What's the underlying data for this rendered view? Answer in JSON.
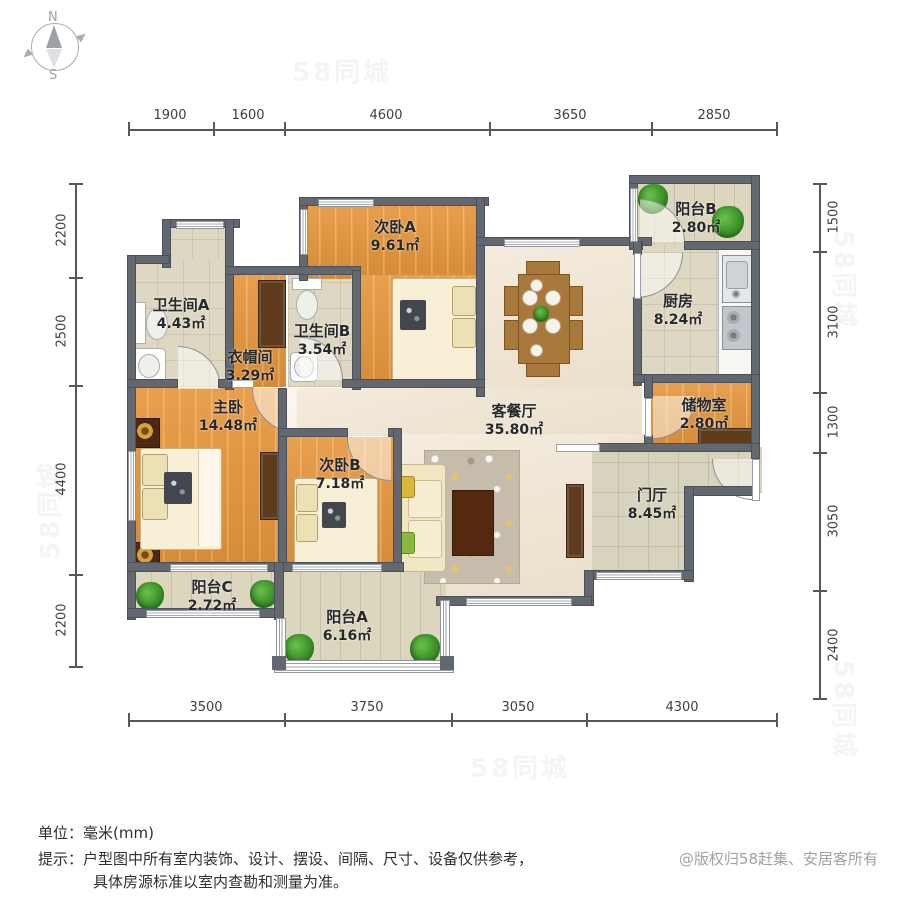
{
  "compass": {
    "north": "N",
    "south": "S"
  },
  "watermark": "58同城",
  "dimensions": {
    "top": [
      "1900",
      "1600",
      "4600",
      "3650",
      "2850"
    ],
    "bottom": [
      "3500",
      "3750",
      "3050",
      "4300"
    ],
    "left": [
      "2200",
      "2500",
      "4400",
      "2200"
    ],
    "right": [
      "1500",
      "3100",
      "1300",
      "3050",
      "2400"
    ]
  },
  "rooms": [
    {
      "id": "bedroom-a",
      "name": "次卧A",
      "area": "9.61㎡"
    },
    {
      "id": "balcony-b",
      "name": "阳台B",
      "area": "2.80㎡"
    },
    {
      "id": "kitchen",
      "name": "厨房",
      "area": "8.24㎡"
    },
    {
      "id": "storage",
      "name": "储物室",
      "area": "2.80㎡"
    },
    {
      "id": "bathroom-a",
      "name": "卫生间A",
      "area": "4.43㎡"
    },
    {
      "id": "cloakroom",
      "name": "衣帽间",
      "area": "3.29㎡"
    },
    {
      "id": "bathroom-b",
      "name": "卫生间B",
      "area": "3.54㎡"
    },
    {
      "id": "living-dining",
      "name": "客餐厅",
      "area": "35.80㎡"
    },
    {
      "id": "master-bedroom",
      "name": "主卧",
      "area": "14.48㎡"
    },
    {
      "id": "bedroom-b",
      "name": "次卧B",
      "area": "7.18㎡"
    },
    {
      "id": "foyer",
      "name": "门厅",
      "area": "8.45㎡"
    },
    {
      "id": "balcony-c",
      "name": "阳台C",
      "area": "2.72㎡"
    },
    {
      "id": "balcony-a",
      "name": "阳台A",
      "area": "6.16㎡"
    }
  ],
  "footer": {
    "unit_label": "单位：毫米(mm)",
    "note_line1": "提示：户型图中所有室内装饰、设计、摆设、间隔、尺寸、设备仅供参考，",
    "note_line2": "具体房源标准以室内查勘和测量为准。"
  },
  "copyright": "@版权归58赶集、安居客所有",
  "colors": {
    "wall": "#63676f",
    "wood_floor": "#e5953a",
    "tile_floor": "#ded8c2",
    "living_floor": "#f2e6d2",
    "balcony_floor": "#dcd6bf",
    "cabinet": "#5e3c1c",
    "plant_green": "#3f9b30",
    "table_wood": "#a9793c"
  }
}
